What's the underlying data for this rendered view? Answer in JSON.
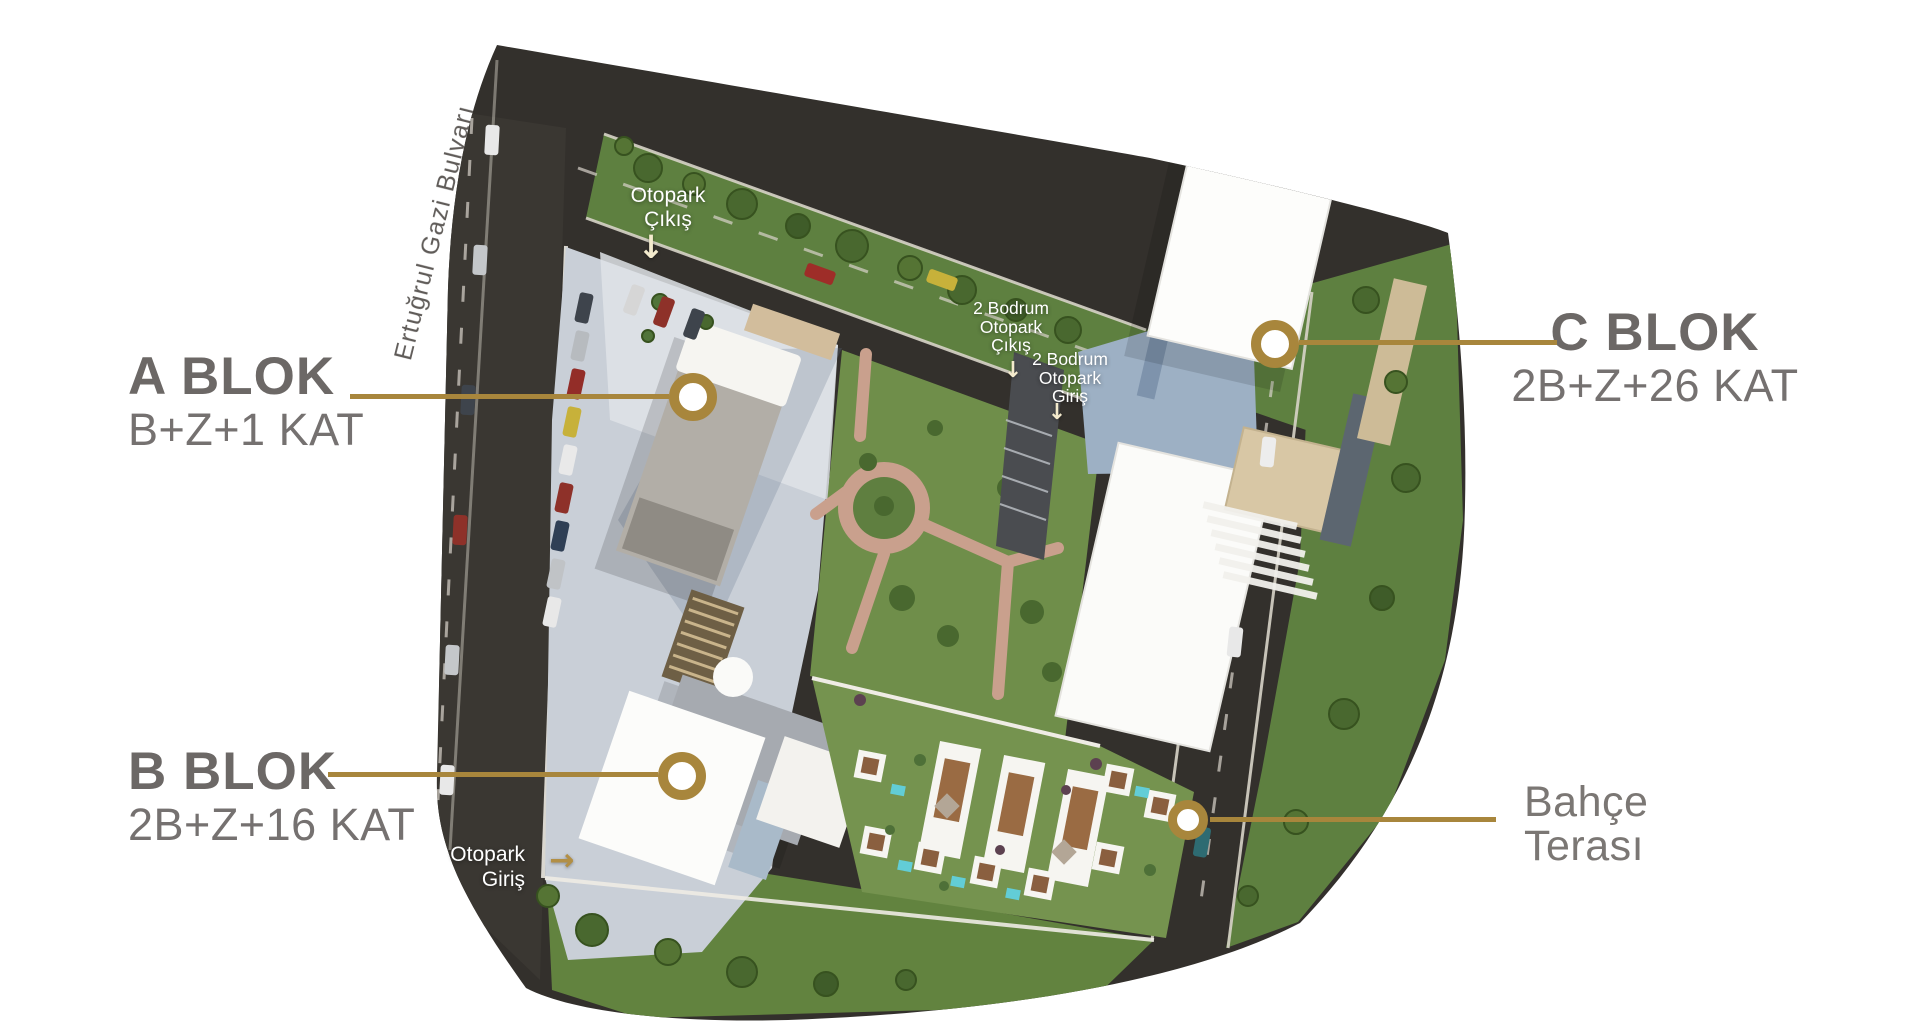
{
  "street": {
    "name": "Ertuğrul Gazi Bulvarı"
  },
  "road_labels": {
    "otopark_cikis": {
      "line1": "Otopark",
      "line2": "Çıkış",
      "arrow": "↓"
    },
    "bodrum_cikis": {
      "line1": "2 Bodrum",
      "line2": "Otopark",
      "line3": "Çıkış",
      "arrow": "↓"
    },
    "bodrum_giris": {
      "line1": "2 Bodrum",
      "line2": "Otopark",
      "line3": "Giriş",
      "arrow": "↓"
    },
    "otopark_giris": {
      "line1": "Otopark",
      "line2": "Giriş",
      "arrow": "→"
    }
  },
  "blocks": {
    "a": {
      "name": "A BLOK",
      "floors": "B+Z+1 KAT"
    },
    "b": {
      "name": "B BLOK",
      "floors": "2B+Z+16 KAT"
    },
    "c": {
      "name": "C BLOK",
      "floors": "2B+Z+26 KAT"
    }
  },
  "garden_terrace": {
    "line1": "Bahçe",
    "line2": "Terası"
  },
  "colors": {
    "accent_gold": "#A8863C",
    "block_title": "#6C6866",
    "block_subtitle": "#757170",
    "terrace_label": "#7B7774",
    "street_label": "#5F5B58",
    "white_label": "#FFFFFF",
    "cream_arrow": "#F3EACD"
  }
}
